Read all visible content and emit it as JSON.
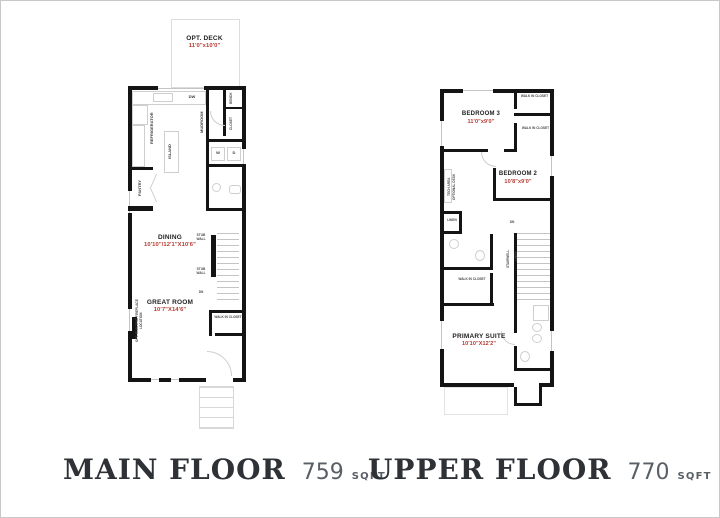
{
  "colors": {
    "wall": "#141414",
    "dimension_red": "#b5382e",
    "room_label": "#1f1f1f",
    "title_dark": "#2e3237",
    "sqft_gray": "#585f66",
    "fixture_gray": "#cfcfcf"
  },
  "main_floor": {
    "title": "MAIN FLOOR",
    "sqft": "759",
    "sqft_unit": "SQFT",
    "deck": {
      "label": "OPT. DECK",
      "dims": "11'0\"x10'0\""
    },
    "rooms": {
      "dining": {
        "label": "DINING",
        "dims": "10'10\"/12'1\"X10'6\""
      },
      "great_room": {
        "label": "GREAT ROOM",
        "dims": "10'7\"X14'6\""
      }
    },
    "annotations": {
      "dw": "DW",
      "refrigerator": "REFRIGERATOR",
      "island": "ISLAND",
      "mudroom": "MUDROOM",
      "bench": "BENCH",
      "closet": "CLOSET",
      "washer": "W",
      "dryer": "D",
      "pantry": "PANTRY",
      "stub_wall": "STUB WALL",
      "dn": "DN",
      "fireplace": "OPT. ELECTRIC FIREPLACE LOCATION",
      "walk_in_closet": "WALK IN CLOSET"
    }
  },
  "upper_floor": {
    "title": "UPPER FLOOR",
    "sqft": "770",
    "sqft_unit": "SQFT",
    "rooms": {
      "bedroom3": {
        "label": "BEDROOM 3",
        "dims": "11'0\"x9'0\""
      },
      "bedroom2": {
        "label": "BEDROOM 2",
        "dims": "10'8\"x9'0\""
      },
      "primary": {
        "label": "PRIMARY SUITE",
        "dims": "10'10\"X12'2\""
      }
    },
    "annotations": {
      "walk_in_closet": "WALK IN CLOSET",
      "tech_area": "TECH AREA",
      "opt_desk": "OPTIONAL DESK",
      "linen": "LINEN",
      "dn": "DN",
      "stairwell": "STAIRWELL"
    }
  }
}
